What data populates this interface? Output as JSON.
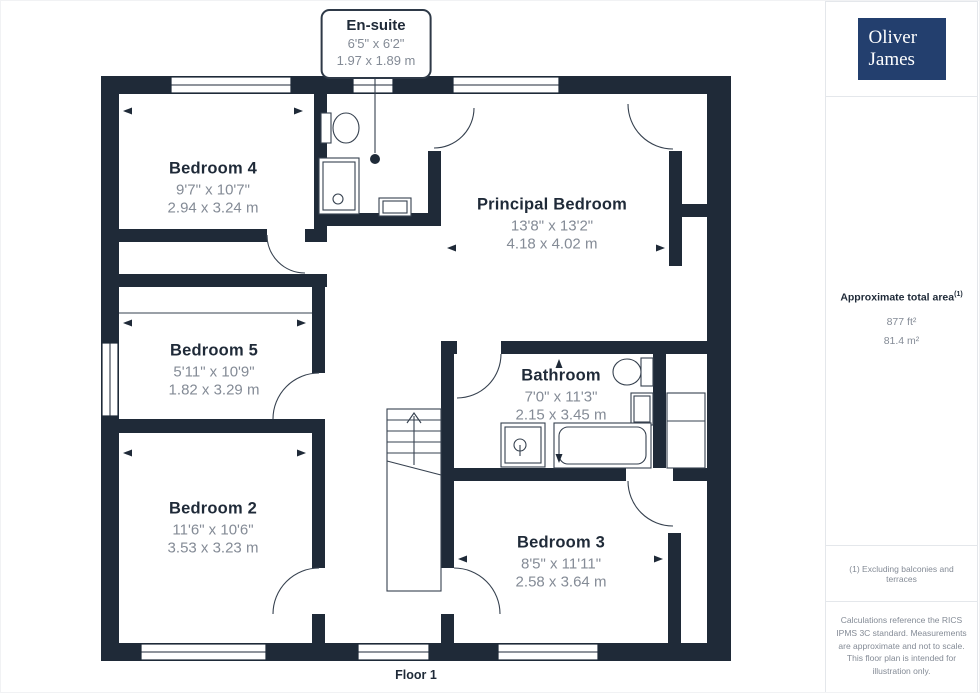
{
  "branding": {
    "logo_line1": "Oliver",
    "logo_line2": "James",
    "giraffe_brand": "GIRAFFE",
    "giraffe_suffix": "360"
  },
  "callout": {
    "title": "En-suite",
    "imperial": "6'5\" x 6'2\"",
    "metric": "1.97 x 1.89 m"
  },
  "rooms": [
    {
      "name": "Bedroom 4",
      "imperial": "9'7\" x 10'7\"",
      "metric": "2.94 x 3.24 m"
    },
    {
      "name": "Principal Bedroom",
      "imperial": "13'8\" x 13'2\"",
      "metric": "4.18 x 4.02 m"
    },
    {
      "name": "Bedroom 5",
      "imperial": "5'11\" x 10'9\"",
      "metric": "1.82 x 3.29 m"
    },
    {
      "name": "Bathroom",
      "imperial": "7'0\" x 11'3\"",
      "metric": "2.15 x 3.45 m"
    },
    {
      "name": "Bedroom 2",
      "imperial": "11'6\" x 10'6\"",
      "metric": "3.53 x 3.23 m"
    },
    {
      "name": "Bedroom 3",
      "imperial": "8'5\" x 11'11\"",
      "metric": "2.58 x 3.64 m"
    }
  ],
  "sidebar": {
    "area_title": "Approximate total area",
    "area_footnote_marker": "(1)",
    "area_sqft": "877 ft²",
    "area_sqm": "81.4 m²",
    "footnote": "(1) Excluding balconies and terraces",
    "disclaimer": "Calculations reference the RICS IPMS 3C standard. Measurements are approximate and not to scale. This floor plan is intended for illustration only."
  },
  "footer": {
    "floor_label": "Floor 1"
  },
  "colors": {
    "wall": "#1F2A38",
    "accent_text": "#1F2A38",
    "dim_text": "#848B96",
    "logo_bg": "#233F6E"
  }
}
